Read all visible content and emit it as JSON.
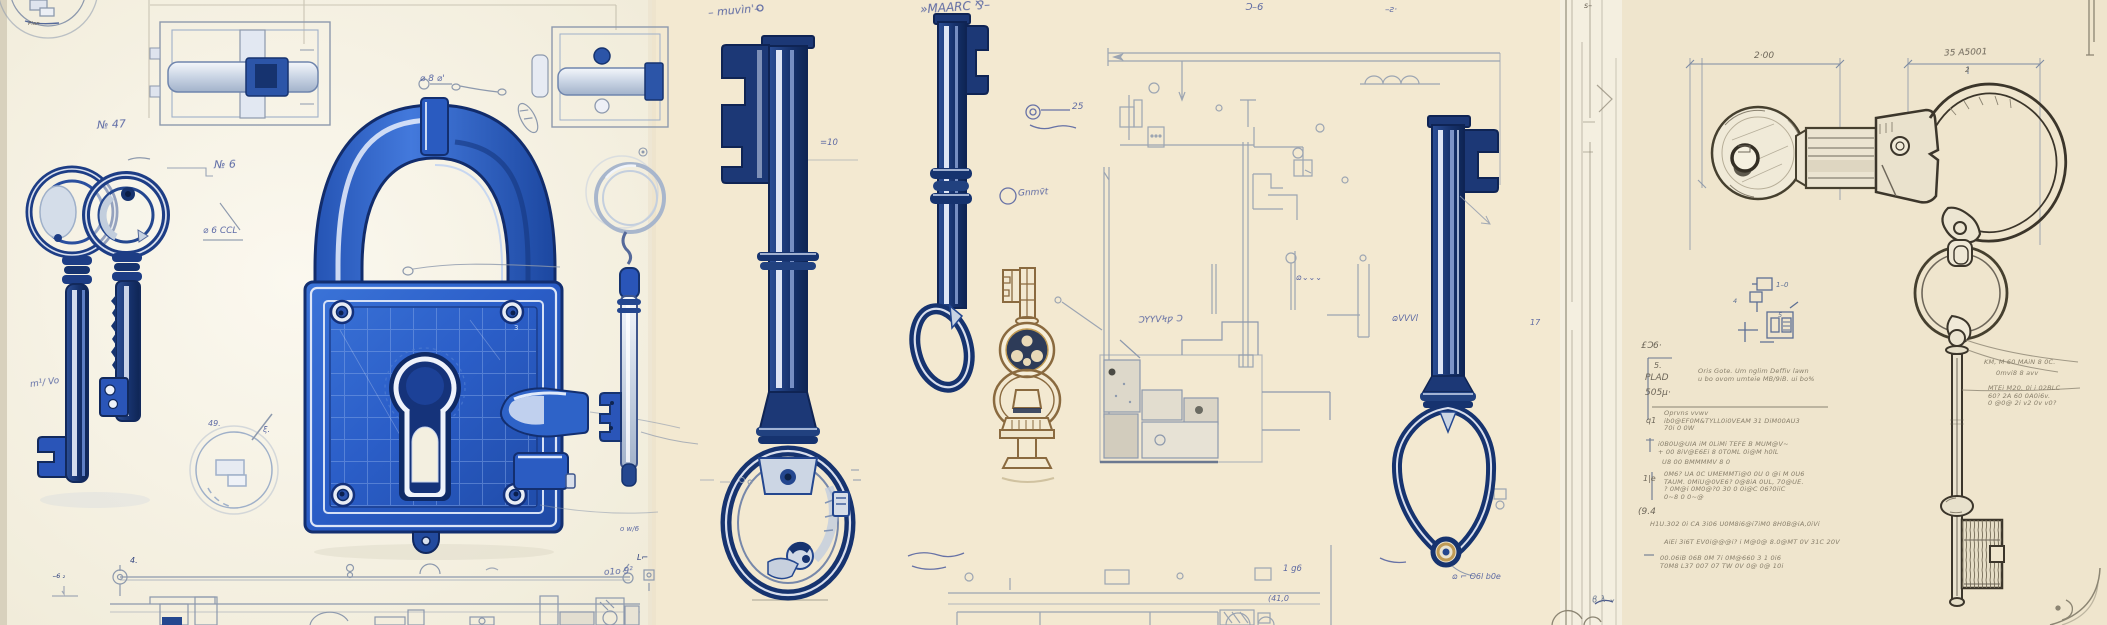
{
  "colors": {
    "paper_left": "#f6f2e6",
    "paper_middle": "#f3e9d1",
    "paper_right": "#efe5cd",
    "padlock_blue": "#2b5ec8",
    "key_navy": "#16316b",
    "bit_blue": "#2a55b8",
    "sepia_ink": "#8a6a3f",
    "handwriting_ink": "#44549b",
    "schematic_blue_gray": "#8d99ad",
    "pencil_gray": "#46402f"
  },
  "panels": {
    "left": {
      "annotations": {
        "plan": "Plan",
        "no47": "№ 47",
        "no6": "№ 6",
        "dia_ccl": "⌀ 6 CCL",
        "dia8": "⌀ 8 ⌀'",
        "m2vo": "m¹/ Vo",
        "mark49": "49.",
        "sig": "ξ.",
        "ow": "o w/6",
        "olo92": "o1o 9²",
        "dim4": "4.",
        "lq": "L⌐",
        "margin": "⌣6 ₂",
        "lock3": "3"
      }
    },
    "middle": {
      "annotations": {
        "scrawl1": "– muvìn'–",
        "scrawl2": "»MAARC ⅋–",
        "scrawl3": "Ɔ–6",
        "scrawl4": "–ƨ·",
        "hash10": "=10",
        "c25": "25",
        "gnmot": "Gnmv̄t",
        "syyv": "ƆYYVϞƿ Ɔ",
        "ovvvl": "ɷVVVl",
        "ovvv": "ɷ⌄⌄⌄",
        "g196": "1 g6",
        "paren41": "(41,0",
        "dleader": "ɷ ⌐ O6l b0e",
        "k17": "17",
        "s_edge": "s–"
      }
    },
    "right": {
      "dims": {
        "d1": "2·00",
        "d2": "35 A5001",
        "d2sub": "2"
      },
      "labels": {
        "eo6": "£Ɔ6·",
        "five": "5.",
        "plad": "PLAD",
        "n505": "505µ·",
        "q1": "q1",
        "onee": "1|e",
        "n194": "(9.4",
        "det10": "1–0",
        "det5": "5",
        "det4": "4",
        "bnw": "ϐ λ ⌄"
      },
      "spec": {
        "b1": [
          "Oris Gote. Um nglim Deffiv  lawn",
          "u bo ovom umteie MB/9iB. ui bo%"
        ],
        "b2": [
          "Oprvns vvwv",
          "ib0@EF0M&TYLL0i0VEAM 31 DiM00AU3",
          "70i 0 0W"
        ],
        "b3": [
          "i0B0U@UIA iM 0LiMi TEFE B MUM@V~",
          "+ 00 8iV@E6Ei 8 0T0ML 0i@M h0lL"
        ],
        "b4": [
          "U8 00 BMMMMV 8 0"
        ],
        "b5": [
          "0M6? UA 0C UMEMMTi@0 0U 0 @i M 0U6",
          "TAUM. 0MiU@0VE6? 0@8iA 0UL, 70@UE.",
          "? 0M@i 0M0@?0 30 0 0i@C 06?0iiC",
          "0~8 0 0~@"
        ],
        "b6": [
          "H1U.302 0i CA 3i06 U0M8i6@i7iM0 8H0B@iA,0iVi"
        ],
        "b7": [
          "AiEi 3i6T EV0i@@@i? i M@0@ 8.0@MT 0V 31C 20V"
        ],
        "b8": [
          "00.06iB 06B 0M 7i 0M@660 3 1 0i6",
          "T0M8 L37 007 07 TW 0V 0@ 0@ 10i"
        ]
      },
      "key_notes": [
        "KM, M 60 MAiN 8 0C.",
        "0mvi8 8 avv",
        "MTEi M20. 0i i 02BLC",
        "60? 2A 60 0A0i6v.",
        "0 @0@ 2i v2 0v v0?"
      ]
    }
  }
}
